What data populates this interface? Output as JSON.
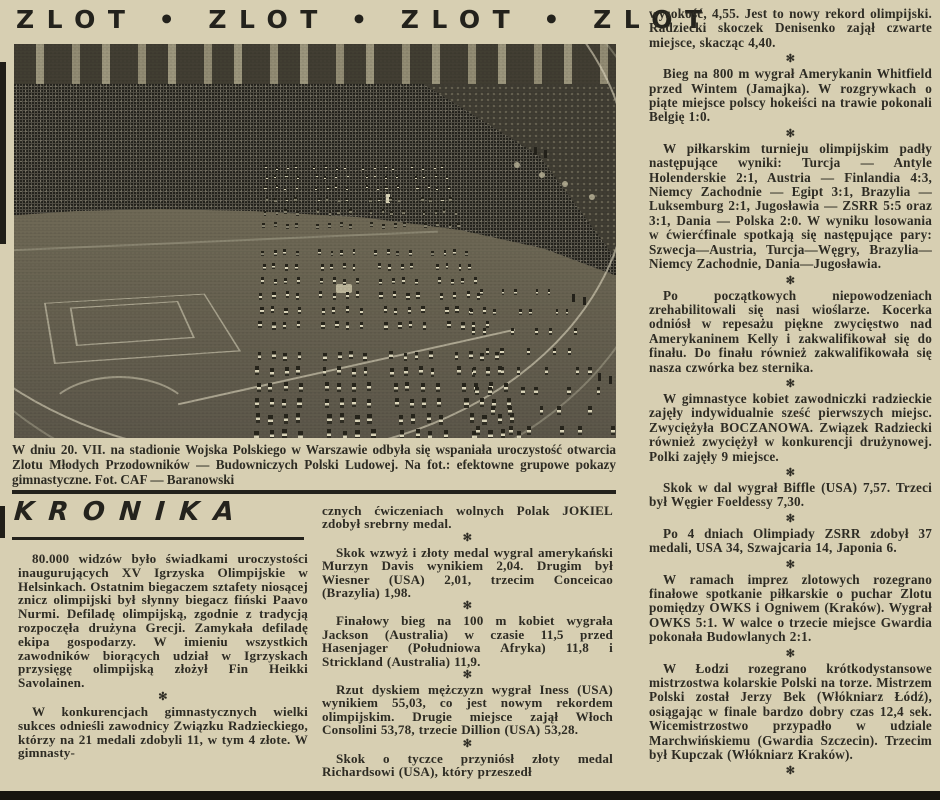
{
  "masthead": {
    "headline": "ZLOT • ZLOT • ZLOT • ZLOT"
  },
  "photo": {
    "caption": "W dniu 20. VII. na stadionie Wojska Polskiego w Warszawie odbyła się wspaniała uroczystość otwarcia Zlotu Młodych Przodowników — Budowniczych Polski Ludowej. Na fot.: efektowne grupowe pokazy gimnastyczne. Fot. CAF — Baranowski"
  },
  "kronika": {
    "title": "KRONIKA"
  },
  "glyphs": {
    "separator": "✻"
  },
  "colors": {
    "paper": "#d7cfb2",
    "ink": "#2e2c24",
    "rule": "#23221c"
  },
  "columns": {
    "left": [
      "80.000 widzów było świadkami uroczystości inaugurujących XV Igrzyska Olimpijskie w Helsinkach. Ostatnim biegaczem sztafety niosącej znicz olimpijski był słynny biegacz fiński Paavo Nurmi. Defiladę olimpijską, zgodnie z tradycją rozpoczęła drużyna Grecji. Zamykała defiladę ekipa gospodarzy. W imieniu wszystkich zawodników biorących udział w Igrzyskach przysięgę olimpijską złożył Fin Heikki Savolainen.",
      "W konkurencjach gimnastycznych wielki sukces odnieśli zawodnicy Związku Radzieckiego, którzy na 21 medali zdobyli 11, w tym 4 złote. W gimnasty-"
    ],
    "middle": [
      "cznych ćwiczeniach wolnych Polak JOKIEL zdobył srebrny medal.",
      "Skok wzwyż i złoty medal wygral amerykański Murzyn Davis wynikiem 2,04. Drugim był Wiesner (USA) 2,01, trzecim Conceicao (Brazylia) 1,98.",
      "Finałowy bieg na 100 m kobiet wygrała Jackson (Australia) w czasie 11,5 przed Hasenjager (Południowa Afryka) 11,8 i Strickland (Australia) 11,9.",
      "Rzut dyskiem mężczyzn wygrał Iness (USA) wynikiem 55,03, co jest nowym rekordem olimpijskim. Drugie miejsce zajął Włoch Consolini 53,78, trzecie Dillion (USA) 53,28.",
      "Skok o tyczce przyniósł złoty medal Richardsowi (USA), który przeszedł"
    ],
    "right": [
      "wysokość, 4,55. Jest to nowy rekord olimpijski. Radziecki skoczek Denisenko zajął czwarte miejsce, skacząc 4,40.",
      "Bieg na 800 m wygrał Amerykanin Whitfield przed Wintem (Jamajka). W rozgrywkach o piąte miejsce polscy hokeiści na trawie pokonali Belgię 1:0.",
      "W piłkarskim turnieju olimpijskim padły następujące wyniki: Turcja — Antyle Holenderskie 2:1, Austria — Finlandia 4:3, Niemcy Zachodnie — Egipt 3:1, Brazylia — Luksemburg 2:1, Jugosławia — ZSRR 5:5 oraz 3:1, Dania — Polska 2:0. W wyniku losowania w ćwierćfinale spotkają się następujące pary: Szwecja—Austria, Turcja—Węgry, Brazylia—Niemcy Zachodnie, Dania—Jugosławia.",
      "Po początkowych niepowodzeniach zrehabilitowali się nasi wioślarze. Kocerka odniósł w repesażu piękne zwycięstwo nad Amerykaninem Kelly i zakwalifikował się do finału. Do finału również zakwalifikowała się nasza czwórka bez sternika.",
      "W gimnastyce kobiet zawodniczki radzieckie zajęły indywidualnie sześć pierwszych miejsc. Zwyciężyła BOCZANOWA. Związek Radziecki również zwyciężył w konkurencji drużynowej. Polki zajęły 9 miejsce.",
      "Skok w dal wygrał Biffle (USA) 7,57. Trzeci był Węgier Foeldessy 7,30.",
      "Po 4 dniach Olimpiady ZSRR zdobył 37 medali, USA 34, Szwajcaria 14, Japonia 6.",
      "W ramach imprez zlotowych rozegrano finałowe spotkanie piłkarskie o puchar Zlotu pomiędzy OWKS i Ogniwem (Kraków). Wygrał OWKS 5:1. W walce o trzecie miejsce Gwardia pokonała Budowlanych 2:1.",
      "W Łodzi rozegrano krótkodystansowe mistrzostwa kolarskie Polski na torze. Mistrzem Polski został Jerzy Bek (Włókniarz Łódź), osiągając w finale bardzo dobry czas 12,4 sek. Wicemistrzostwo przypadło w udziale Marchwińskiemu (Gwardia Szczecin). Trzecim był Kupczak (Włókniarz Kraków)."
    ]
  }
}
